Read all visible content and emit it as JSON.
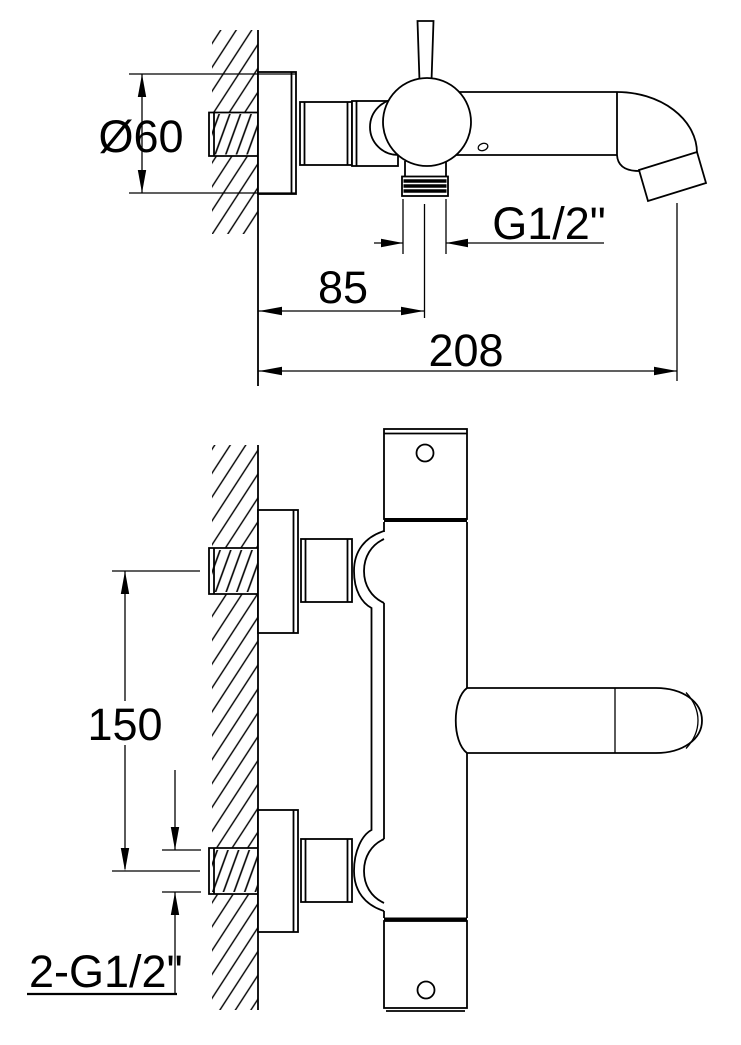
{
  "page": {
    "paper_color": "#ffffff",
    "ink_color": "#000000"
  },
  "drawing": {
    "upper_view": {
      "dims": {
        "diameter": "Ø60",
        "thread": "G1/2\"",
        "offset": "85",
        "reach": "208"
      }
    },
    "lower_view": {
      "dims": {
        "spacing": "150",
        "connections": "2-G1/2\""
      }
    }
  }
}
